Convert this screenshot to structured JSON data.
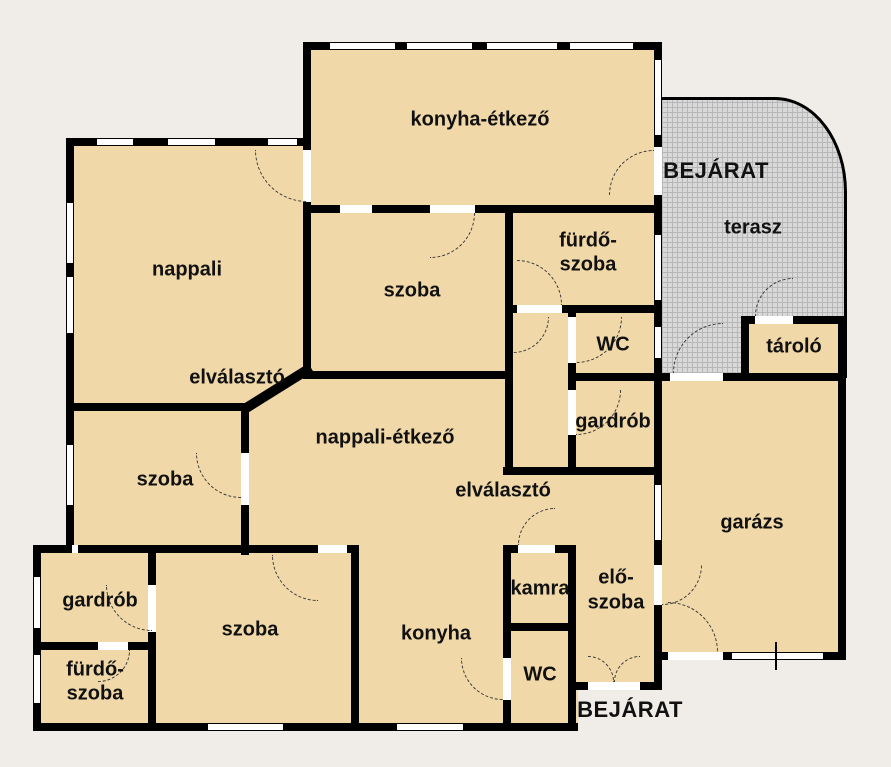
{
  "plan": {
    "type": "floor-plan",
    "colors": {
      "background": "#f0ede8",
      "room_fill": "#f0d8a8",
      "wall": "#000000",
      "terrace_fill": "#d9d9d9",
      "terrace_grid": "#b7b7b7",
      "watermark": "#a99877"
    },
    "watermark": {
      "logo": "OC",
      "line1": "OTTHON",
      "line2": "CENTRUM"
    },
    "labels": {
      "konyha_etkezo": "konyha-étkező",
      "bejarat_top": "BEJÁRAT",
      "terasz": "terasz",
      "nappali": "nappali",
      "szoba_top": "szoba",
      "furdo_top_1": "fürdő-",
      "furdo_top_2": "szoba",
      "wc_top": "WC",
      "tarolo": "tároló",
      "elvalaszto_top": "elválasztó",
      "gardrob_mid": "gardrób",
      "nappali_etkezo": "nappali-étkező",
      "elvalaszto_bottom": "elválasztó",
      "szoba_left": "szoba",
      "garazs": "garázs",
      "gardrob_bottom": "gardrób",
      "szoba_bottom": "szoba",
      "konyha": "konyha",
      "kamra": "kamra",
      "elo_1": "elő-",
      "elo_2": "szoba",
      "furdo_bottom_1": "fürdő-",
      "furdo_bottom_2": "szoba",
      "wc_bottom": "WC",
      "bejarat_bottom": "BEJÁRAT"
    }
  }
}
